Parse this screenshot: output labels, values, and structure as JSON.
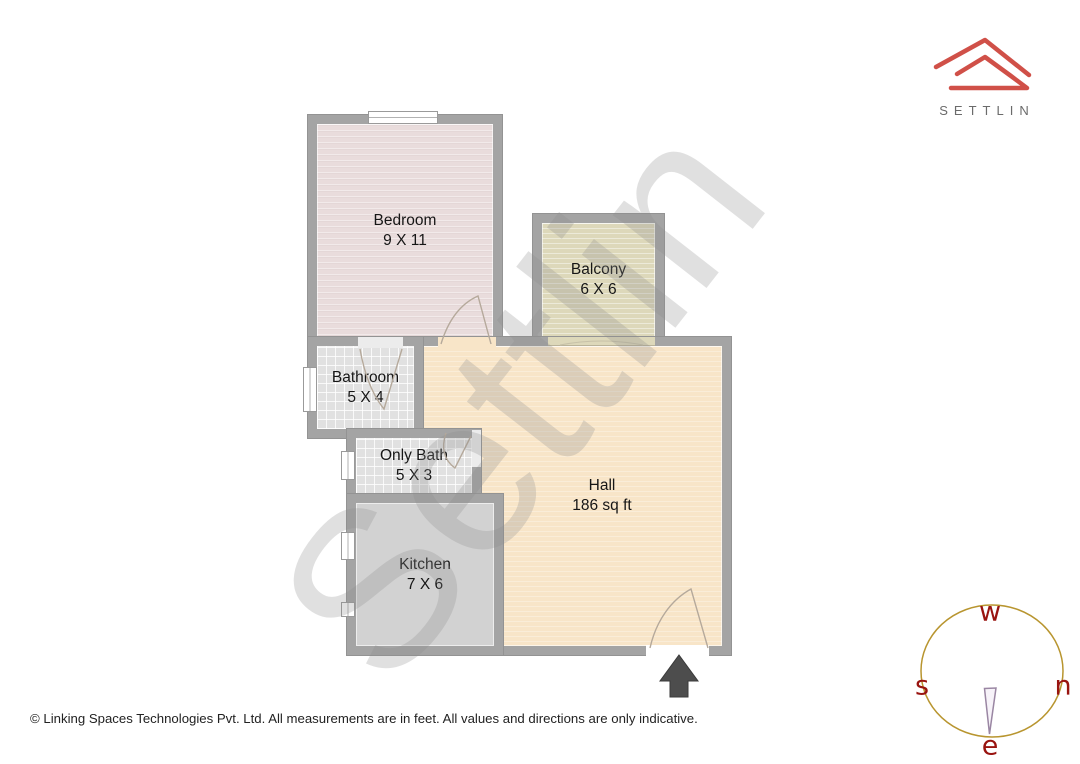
{
  "branding": {
    "logo_text": "SETTLIN"
  },
  "watermark": {
    "text": "Settlin"
  },
  "plan": {
    "rooms": {
      "bedroom": {
        "name": "Bedroom",
        "dims": "9 X 11"
      },
      "balcony": {
        "name": "Balcony",
        "dims": "6 X 6"
      },
      "bathroom": {
        "name": "Bathroom",
        "dims": "5 X 4"
      },
      "only_bath": {
        "name": "Only Bath",
        "dims": "5 X 3"
      },
      "kitchen": {
        "name": "Kitchen",
        "dims": "7 X 6"
      },
      "hall": {
        "name": "Hall",
        "dims": "186 sq ft"
      }
    }
  },
  "compass": {
    "top": "w",
    "left": "s",
    "right": "n",
    "bottom": "e"
  },
  "footer": {
    "text": "© Linking Spaces Technologies Pvt. Ltd. All measurements are in feet. All values and directions are only indicative."
  },
  "colors": {
    "accent_red": "#d05048",
    "wall": "#a4a4a4",
    "floor_bedroom": "#e9dcdc",
    "floor_balcony": "#ddd8ba",
    "floor_bath_tile": "#e1e1e1",
    "floor_kitchen": "#d2d2d2",
    "floor_hall": "#f8e5c8",
    "compass_ring": "#b8952f",
    "compass_letters": "#991410",
    "arrow": "#4d4d4d",
    "logo_text_color": "#6b6b6b"
  },
  "icons": {
    "logo": "settlin-house-icon",
    "entrance": "entrance-arrow-icon",
    "compass_ring": "compass-ring-icon",
    "compass_needle": "compass-needle-icon"
  }
}
